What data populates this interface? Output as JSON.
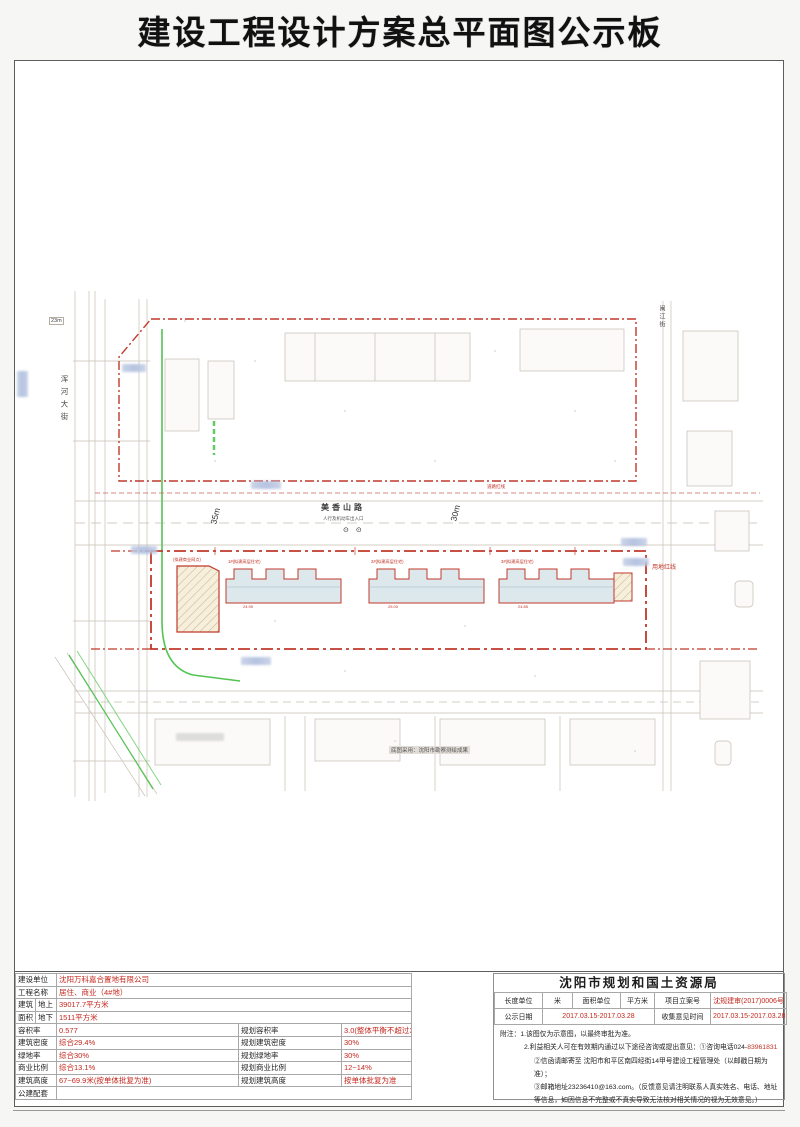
{
  "title": "建设工程设计方案总平面图公示板",
  "colors": {
    "accent_red": "#c4281e",
    "boundary_red": "#c0392b",
    "green_line": "#53c453",
    "blur_label_blue": "#a9b9dc"
  },
  "map": {
    "road_left_name": "浑河大街",
    "road_left_dim": "23m",
    "road_main_name": "美香山路",
    "dim_west": "35m",
    "dim_east": "30m",
    "entrance_text": "人行及机动车出入口",
    "entrance_symbols": "⊙⊙",
    "boundary_label": "用地红线",
    "roadline_label": "道路红线",
    "road_right_name": "闽江街",
    "buildings": {
      "left": "(拟建商业网点)",
      "b1": "1#(拟建高层住宅)",
      "b2": "2#(拟建高层住宅)",
      "b3": "3#(拟建高层住宅)"
    },
    "elevations": {
      "e1": "24.95",
      "e2": "25.00",
      "e3": "24.85"
    },
    "survey_note": "底图采用：沈阳市勘察测绘成果"
  },
  "project_table": {
    "rows": [
      {
        "label": "建设单位",
        "value": "沈阳万科嘉合置地有限公司"
      },
      {
        "label": "工程名称",
        "value": "居住、商业（4#地）"
      },
      {
        "group": "建筑",
        "sub": "地上",
        "value": "39017.7平方米"
      },
      {
        "group": "面积",
        "sub": "地下",
        "value": "1511平方米"
      },
      {
        "label": "容积率",
        "value": "0.577",
        "label2": "规划容积率",
        "value2": "3.0(整体平衡不超过3.0)"
      },
      {
        "label": "建筑密度",
        "value": "综合29.4%",
        "label2": "规划建筑密度",
        "value2": "30%"
      },
      {
        "label": "绿地率",
        "value": "综合30%",
        "label2": "规划绿地率",
        "value2": "30%"
      },
      {
        "label": "商业比例",
        "value": "综合13.1%",
        "label2": "规划商业比例",
        "value2": "12~14%"
      },
      {
        "label": "建筑高度",
        "value": "67~69.9米(按单体批复为准)",
        "label2": "规划建筑高度",
        "value2": "按单体批复为准"
      },
      {
        "label": "公建配套",
        "value": ""
      }
    ]
  },
  "authority_table": {
    "header": "沈阳市规划和国土资源局",
    "unit_row": {
      "c1": "长度单位",
      "v1": "米",
      "c2": "面积单位",
      "v2": "平方米",
      "c3": "项目立案号",
      "v3": "沈规建审(2017)0006号"
    },
    "date_row": {
      "c1": "公示日期",
      "v1": "2017.03.15-2017.03.28",
      "c2": "收集意见时间",
      "v2": "2017.03.15-2017.03.28"
    },
    "notes": {
      "line1": "附注：1.该图仅为示意图，以最终审批为准。",
      "line2_black": "2.利益相关人可在有效期内通过以下途径咨询或提出意见：①咨询电话024-",
      "line2_red": "83961831",
      "line3": "②信函请邮寄至 沈阳市和平区南四经街14甲号建设工程管理处（以邮戳日期为准）；",
      "line4": "③邮箱地址23236410@163.com。（反馈意见请注明联系人真实姓名、电话、地址等信息，如因信息不完整或不真实导致无法核对相关情况的视为无效意见。）"
    }
  }
}
